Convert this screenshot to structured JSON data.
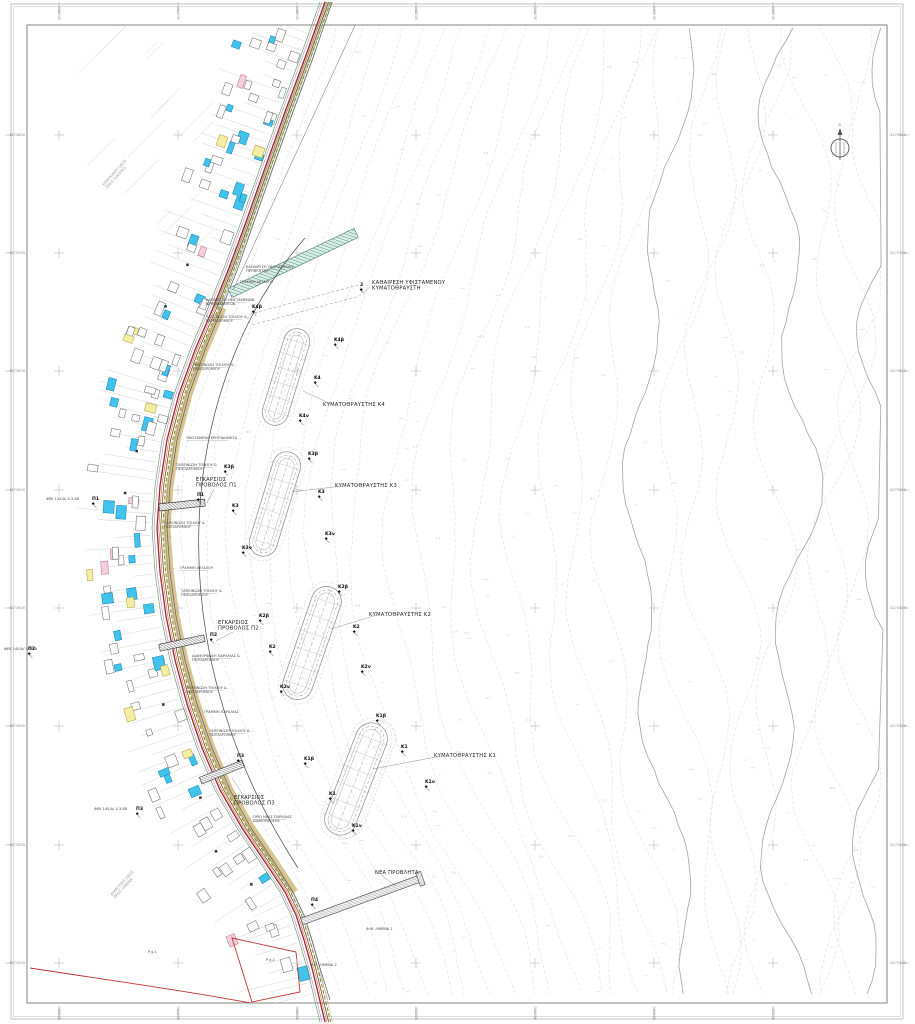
{
  "page": {
    "width": 915,
    "height": 1024,
    "background": "#ffffff"
  },
  "north_arrow": {
    "label": "Β",
    "icon": "compass-north-icon"
  },
  "grid": {
    "eastings": [
      "302600",
      "302700",
      "302800",
      "302900",
      "303000",
      "303100",
      "303200"
    ],
    "northings": [
      "4273800",
      "4273700",
      "4273600",
      "4273500",
      "4273400",
      "4273300",
      "4273200",
      "4273100"
    ]
  },
  "colors": {
    "building_fill": "#41c3ee",
    "building_stroke": "#0e7fae",
    "parcel_yellow": "#f4eea4",
    "beach_tan": "#d6c28b",
    "road_red": "#9b2b2b",
    "boundary_red": "#c23333",
    "demolition_teal": "#3d8a70",
    "contour_gray": "#d2d2d2"
  },
  "labels": {
    "breakwater_titles": [
      {
        "text": "ΚΥΜΑΤΟΘΡΑΥΣΤΗΣ Κ4",
        "x": 323,
        "y": 406
      },
      {
        "text": "ΚΥΜΑΤΟΘΡΑΥΣΤΗΣ Κ3",
        "x": 335,
        "y": 487
      },
      {
        "text": "ΚΥΜΑΤΟΘΡΑΥΣΤΗΣ Κ2",
        "x": 369,
        "y": 616
      },
      {
        "text": "ΚΥΜΑΤΟΘΡΑΥΣΤΗΣ Κ1",
        "x": 434,
        "y": 757
      }
    ],
    "area_titles": [
      {
        "lines": [
          "ΚΑΘΑΙΡΕΣΗ ΥΦΙΣΤΑΜΕΝΟΥ",
          "ΚΥΜΑΤΟΘΡΑΥΣΤΗ"
        ],
        "x": 372,
        "y": 284
      },
      {
        "lines": [
          "ΕΓΚΑΡΣΙΟΣ",
          "ΠΡΟΒΟΛΟΣ Π1"
        ],
        "x": 196,
        "y": 481
      },
      {
        "lines": [
          "ΕΓΚΑΡΣΙΟΣ",
          "ΠΡΟΒΟΛΟΣ Π2"
        ],
        "x": 218,
        "y": 624
      },
      {
        "lines": [
          "ΕΓΚΑΡΣΙΟΣ",
          "ΠΡΟΒΟΛΟΣ Π3"
        ],
        "x": 234,
        "y": 799
      },
      {
        "lines": [
          "ΝΕΑ ΠΡΟΒΛΗΤΑ"
        ],
        "x": 375,
        "y": 874
      }
    ],
    "points": [
      {
        "t": "2",
        "x": 360,
        "y": 286
      },
      {
        "t": "Κ4β",
        "x": 252,
        "y": 308
      },
      {
        "t": "Κ4β",
        "x": 334,
        "y": 341
      },
      {
        "t": "Κ4",
        "x": 314,
        "y": 379
      },
      {
        "t": "Κ4ν",
        "x": 299,
        "y": 417
      },
      {
        "t": "Κ3β",
        "x": 224,
        "y": 468
      },
      {
        "t": "Κ3",
        "x": 232,
        "y": 507
      },
      {
        "t": "Κ3ν",
        "x": 242,
        "y": 549
      },
      {
        "t": "Κ3β",
        "x": 308,
        "y": 455
      },
      {
        "t": "Κ3",
        "x": 318,
        "y": 493
      },
      {
        "t": "Κ3ν",
        "x": 325,
        "y": 535
      },
      {
        "t": "Κ2β",
        "x": 259,
        "y": 617
      },
      {
        "t": "Κ2",
        "x": 269,
        "y": 648
      },
      {
        "t": "Κ2ν",
        "x": 280,
        "y": 688
      },
      {
        "t": "Κ2β",
        "x": 338,
        "y": 588
      },
      {
        "t": "Κ2",
        "x": 353,
        "y": 628
      },
      {
        "t": "Κ2ν",
        "x": 361,
        "y": 668
      },
      {
        "t": "Κ1β",
        "x": 304,
        "y": 760
      },
      {
        "t": "Κ1",
        "x": 329,
        "y": 795
      },
      {
        "t": "Κ1ν",
        "x": 352,
        "y": 827
      },
      {
        "t": "Κ1β",
        "x": 376,
        "y": 717
      },
      {
        "t": "Κ1",
        "x": 401,
        "y": 748
      },
      {
        "t": "Κ1ν",
        "x": 425,
        "y": 783
      },
      {
        "t": "Π1",
        "x": 197,
        "y": 496
      },
      {
        "t": "Π2",
        "x": 210,
        "y": 636
      },
      {
        "t": "Π3",
        "x": 237,
        "y": 757
      },
      {
        "t": "Π1",
        "x": 92,
        "y": 500
      },
      {
        "t": "Π2",
        "x": 28,
        "y": 650
      },
      {
        "t": "Π3",
        "x": 136,
        "y": 810
      },
      {
        "t": "Π4",
        "x": 311,
        "y": 901
      }
    ],
    "callouts": [
      {
        "lines": [
          "ΚΑΘΑΙΡΕΣΗ ΥΦΙΣΤΑΜΕΝΗΣ",
          "ΠΡΟΒΛΗΤΑΣ"
        ],
        "x": 246,
        "y": 268,
        "leader": true
      },
      {
        "lines": [
          "ΓΡΑΜΜΗ ΑΙΓΙΑΛΟΥ"
        ],
        "x": 240,
        "y": 283,
        "leader": false
      },
      {
        "lines": [
          "ΚΑΘΑΙΡΕΣΗ ΥΦΙΣΤΑΜΕΝΩΝ",
          "ΚΡΗΠΙΔΩΜΑΤΩΝ"
        ],
        "x": 206,
        "y": 301,
        "leader": true
      },
      {
        "lines": [
          "ΤΑΠΕΙΝΩΣΗ ΤΟΙΧΙΟΥ &",
          "ΠΕΖΟΔΡΟΜΙΟΥ"
        ],
        "x": 206,
        "y": 318,
        "leader": true
      },
      {
        "lines": [
          "ΤΑΠΕΙΝΩΣΗ ΤΟΙΧΙΟΥ &",
          "ΠΕΖΟΔΡΟΜΙΟΥ"
        ],
        "x": 193,
        "y": 366,
        "leader": true
      },
      {
        "lines": [
          "ΥΦΙΣΤΑΜΕΝΑ ΚΡΗΠΙΔΩΜΑΤΑ"
        ],
        "x": 186,
        "y": 439,
        "leader": true
      },
      {
        "lines": [
          "ΤΑΠΕΙΝΩΣΗ ΤΟΙΧΙΟΥ &",
          "ΠΕΖΟΔΡΟΜΙΟΥ"
        ],
        "x": 176,
        "y": 466,
        "leader": true
      },
      {
        "lines": [
          "ΤΑΠΕΙΝΩΣΗ ΤΟΙΧΙΟΥ &",
          "ΠΕΖΟΔΡΟΜΙΟΥ"
        ],
        "x": 164,
        "y": 524,
        "leader": true
      },
      {
        "lines": [
          "ΓΡΑΜΜΗ ΑΙΓΙΑΛΟΥ"
        ],
        "x": 180,
        "y": 569,
        "leader": true
      },
      {
        "lines": [
          "ΤΑΠΕΙΝΩΣΗ ΤΟΙΧΙΟΥ &",
          "ΠΕΖΟΔΡΟΜΙΟΥ"
        ],
        "x": 181,
        "y": 592,
        "leader": true
      },
      {
        "lines": [
          "ΔΙΑΜΟΡΦΩΣΗ ΠΑΡΑΛΙΑΣ &",
          "ΠΕΖΟΔΡΟΜΙΟΥ"
        ],
        "x": 192,
        "y": 657,
        "leader": true
      },
      {
        "lines": [
          "ΤΑΠΕΙΝΩΣΗ ΤΟΙΧΙΟΥ &",
          "ΠΕΖΟΔΡΟΜΙΟΥ"
        ],
        "x": 186,
        "y": 689,
        "leader": true
      },
      {
        "lines": [
          "ΓΡΑΜΜΗ ΠΑΡΑΛΙΑΣ"
        ],
        "x": 204,
        "y": 713,
        "leader": false
      },
      {
        "lines": [
          "ΤΑΠΕΙΝΩΣΗ ΤΟΙΧΙΟΥ &",
          "ΠΕΖΟΔΡΟΜΙΟΥ"
        ],
        "x": 209,
        "y": 732,
        "leader": true
      },
      {
        "lines": [
          "ΟΡΙΟ ΝΕΑΣ ΠΑΡΑΛΙΑΣ",
          "ΔΙΑΜΟΡΦΩΣΗΣ"
        ],
        "x": 253,
        "y": 818,
        "leader": true
      },
      {
        "lines": [
          "Φ.Μ. ΛΙΜΕΝΑ 1"
        ],
        "x": 366,
        "y": 930,
        "leader": false
      },
      {
        "lines": [
          "Φ.Μ. ΛΙΜΕΝΑ 2"
        ],
        "x": 310,
        "y": 966,
        "leader": false
      },
      {
        "lines": [
          "Ρ.χ.1"
        ],
        "x": 148,
        "y": 953,
        "leader": false
      },
      {
        "lines": [
          "Ρ.χ.2"
        ],
        "x": 266,
        "y": 961,
        "leader": false
      },
      {
        "lines": [
          "ΦΕΚ 145/Δ/ 4.3.88"
        ],
        "x": 46,
        "y": 500,
        "leader": false
      },
      {
        "lines": [
          "ΦΕΚ 145/Δ/ 4.3.88"
        ],
        "x": 4,
        "y": 650,
        "leader": false
      },
      {
        "lines": [
          "ΦΕΚ 145/Δ/ 4.3.88"
        ],
        "x": 94,
        "y": 810,
        "leader": false
      }
    ],
    "road_notes": [
      {
        "lines": [
          "ΕΠΑΡΧΙΑΚΗ ΟΔΟΣ",
          "ΠΡΟΣ ΟΙΚΙΣΜΟ"
        ],
        "x": 104,
        "y": 186,
        "angle": -48
      },
      {
        "lines": [
          "ΔΗΜΟΤΙΚΗ ΟΔΟΣ",
          "ΠΡΟΣ ΛΙΜΕΝΑ"
        ],
        "x": 112,
        "y": 896,
        "angle": -48
      }
    ]
  }
}
